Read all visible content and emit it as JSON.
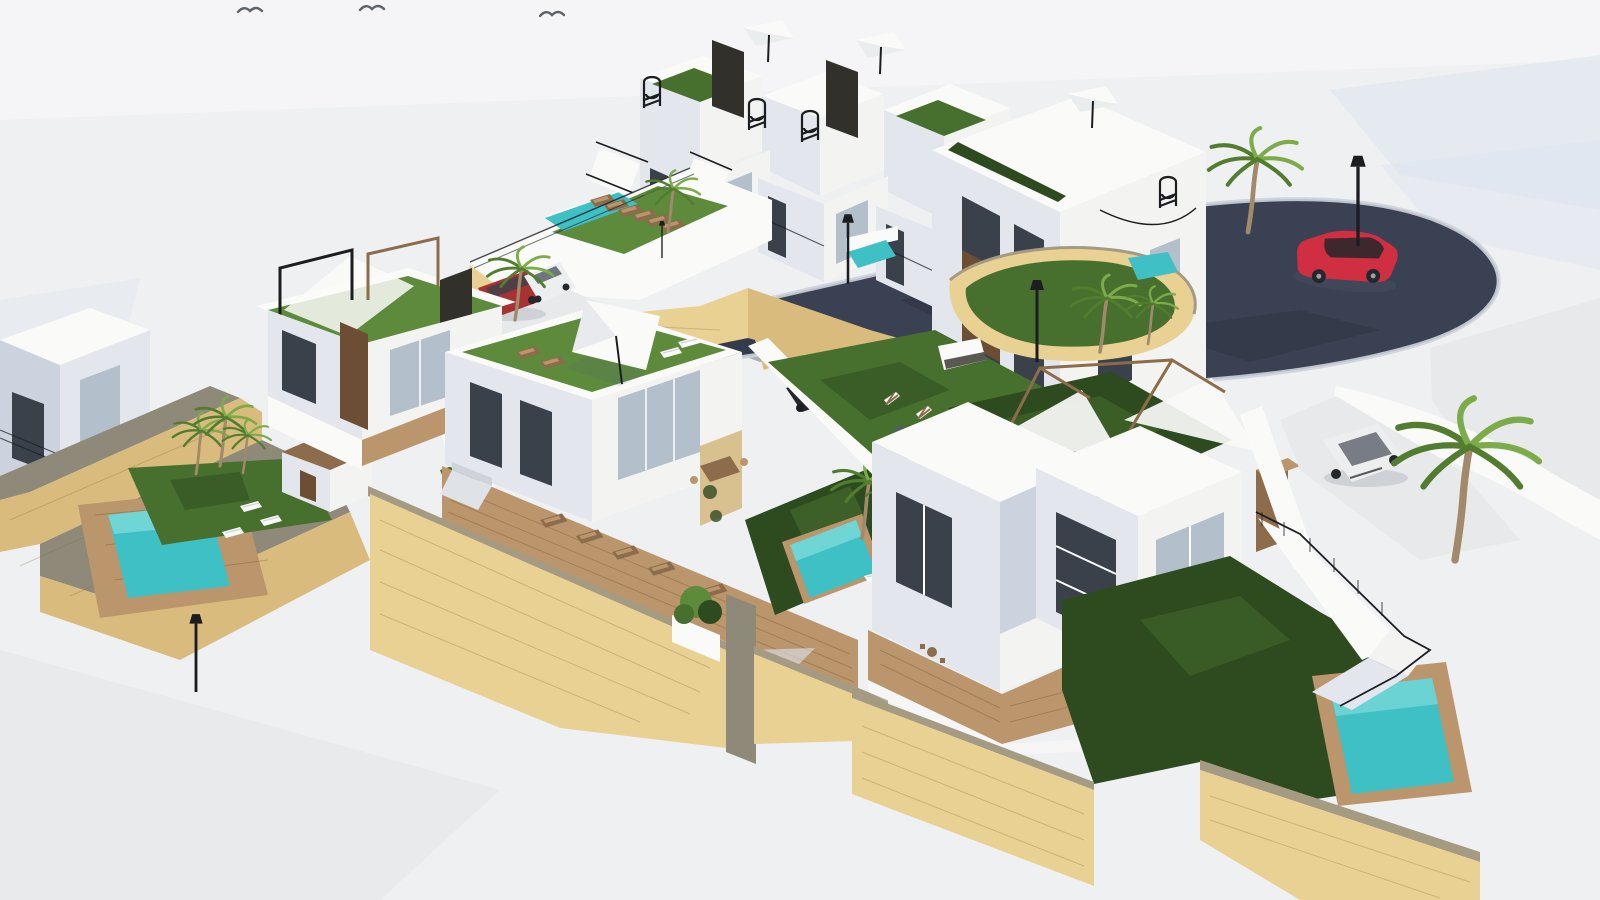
{
  "scene": {
    "type": "3d-architectural-render",
    "subject": "Aerial 3D rendering of a hillside villa development with white modern houses, green roof terraces, turquoise swimming pools, palm trees, sandstone retaining walls and a curving dark asphalt road",
    "text_content": "none"
  },
  "colors": {
    "sky": "#eff0f2",
    "sky_hi": "#f6f6f7",
    "tint": "#dce4ef",
    "pave": "#e8e9eb",
    "wall": "#f3f3f1",
    "wall_lit": "#fafaf8",
    "wall_sh": "#e3e7ed",
    "wall_sh2": "#ccd3de",
    "stone": "#e9d194",
    "stone_dk": "#d9bc7d",
    "stone_top": "#a59a82",
    "stone_gray": "#8f897a",
    "grass": "#5d8a3b",
    "grass_mid": "#47702e",
    "grass_dk": "#2e4a1f",
    "pool": "#3fc0c5",
    "pool_hi": "#8fe2df",
    "road": "#3a4152",
    "road_dk": "#2b3140",
    "curb": "#cdd2da",
    "wood": "#bb966c",
    "wood_dk": "#8c6c4b",
    "glass": "#3a414b",
    "glass_hi": "#b3bfcb",
    "frame": "#6b4e33",
    "panel": "#32302b",
    "metal": "#1b1d21",
    "bird": "#5d6269",
    "car_red": "#d02f41",
    "car_red_dark": "#a83232",
    "car_white": "#eceef0",
    "car_black": "#24272c",
    "tile": "#d9c08f",
    "trunk": "#a18a69",
    "palm": "#7cab49",
    "palm_dk": "#527d2f",
    "shadow": "rgba(90,100,120,0.18)"
  },
  "inventory": {
    "building_volumes": 13,
    "pools": 7,
    "palm_trees": 11,
    "street_lamps": 5,
    "birds": 3,
    "parasols": 4,
    "pergola_frames": 4,
    "canopy_sails": 3,
    "spiral_staircases": 4,
    "sun_loungers": 18,
    "deck_chairs": 4,
    "bbq_units": 1,
    "sofas": 1,
    "dining_tables": 1,
    "bistro_sets": 1,
    "poufs": 1,
    "cars": [
      {
        "color": "red",
        "location": "road"
      },
      {
        "color": "dark-red",
        "location": "parking-area"
      },
      {
        "color": "white",
        "location": "parking-area"
      },
      {
        "color": "black",
        "location": "carport"
      },
      {
        "color": "white",
        "location": "driveway"
      }
    ]
  }
}
